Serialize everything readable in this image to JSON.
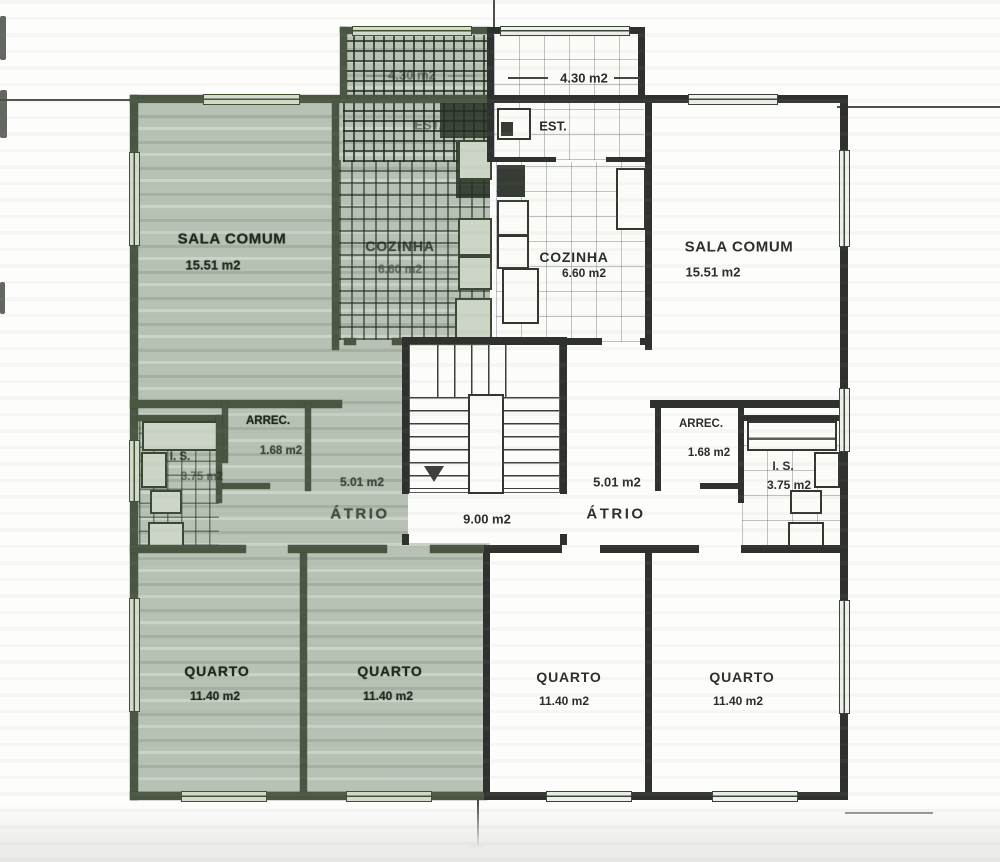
{
  "drawing": {
    "type": "floor-plan",
    "language": "pt",
    "highlighted_unit": "left",
    "colors": {
      "left_unit_tint": "#b7c2b4",
      "wall_left_unit": "#4a5542",
      "wall_right_unit": "#2f312e",
      "paper": "#fdfdfc"
    }
  },
  "rooms": {
    "left_sala": {
      "name": "SALA COMUM",
      "area": "15.51 m2"
    },
    "left_est": {
      "name": "EST.",
      "area": "4.30 m2"
    },
    "left_cozinha": {
      "name": "COZINHA",
      "area": "6.60 m2"
    },
    "left_arrec": {
      "name": "ARREC.",
      "area": "1.68 m2"
    },
    "left_is": {
      "name": "I. S.",
      "area": "3.75 m2"
    },
    "left_atrio": {
      "name": "ÁTRIO",
      "area": "5.01 m2"
    },
    "left_quarto_1": {
      "name": "QUARTO",
      "area": "11.40 m2"
    },
    "left_quarto_2": {
      "name": "QUARTO",
      "area": "11.40 m2"
    },
    "stairwell": {
      "name": "",
      "area": "9.00 m2"
    },
    "right_est": {
      "name": "EST.",
      "area": "4.30 m2"
    },
    "right_cozinha": {
      "name": "COZINHA",
      "area": "6.60 m2"
    },
    "right_sala": {
      "name": "SALA COMUM",
      "area": "15.51 m2"
    },
    "right_arrec": {
      "name": "ARREC.",
      "area": "1.68 m2"
    },
    "right_is": {
      "name": "I. S.",
      "area": "3.75 m2"
    },
    "right_atrio": {
      "name": "ÁTRIO",
      "area": "5.01 m2"
    },
    "right_quarto_1": {
      "name": "QUARTO",
      "area": "11.40 m2"
    },
    "right_quarto_2": {
      "name": "QUARTO",
      "area": "11.40 m2"
    }
  }
}
